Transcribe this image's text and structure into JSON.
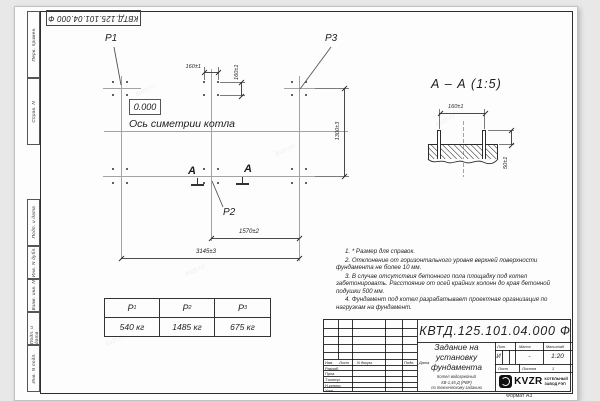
{
  "drawing": {
    "designation": "КВТД.125.101.04.000 Ф",
    "corner_designation": "КВТД.125.101.04.000 Ф",
    "format": "Формат А3",
    "watermark": "kvzr.ru"
  },
  "margin_column": {
    "labels": [
      "Перв. примен.",
      "Справ. N",
      "Подп. и дата",
      "Инв. N дубл.",
      "Взам. инв. N",
      "Подп. и дата",
      "Инв. N подл."
    ]
  },
  "plan": {
    "point1": "P1",
    "point2": "P2",
    "point3": "P3",
    "elevation": "0.000",
    "symmetry_label": "Ось симетрии котла",
    "section_mark_left": "А",
    "section_mark_right": "А",
    "dim_160_horizontal": "160±1",
    "dim_160_vertical": "160±1",
    "dim_1300": "1300±3",
    "dim_1570": "1570±2",
    "dim_3145": "3145±3"
  },
  "section_view": {
    "title": "А – А (1:5)",
    "dim_160": "160±1",
    "dim_50": "50±1"
  },
  "load_table": {
    "columns": [
      {
        "base": "P",
        "sub": "1",
        "value": "540 кг"
      },
      {
        "base": "P",
        "sub": "2",
        "value": "1485 кг"
      },
      {
        "base": "P",
        "sub": "3",
        "value": "675 кг"
      }
    ]
  },
  "notes": {
    "items": [
      "1. * Размер для справок.",
      "2. Отклонение от горизонтального уровня верхней поверхности фундамента не более 10 мм.",
      "3. В случае отсутствия бетонного пола площадку под котел забетонировать. Расстояние от осей крайних колонн до края бетонной подушки 500 мм.",
      "4. Фундамент под котел разрабатывает проектная организация по нагрузкам на фундамент."
    ]
  },
  "title_block": {
    "designation": "КВТД.125.101.04.000 Ф",
    "title": "Задание на установку фундамента",
    "product_line1": "Котел водогрейный",
    "product_line2": "КВ-1,45 Д (РВР)",
    "product_line3": "по техническому заданию",
    "col_izm": "Изм.",
    "col_list": "Лист",
    "col_doc": "N докум.",
    "col_podp": "Подп.",
    "col_data": "Дата",
    "row_razrab": "Разраб.",
    "row_prov": "Пров.",
    "row_tkontr": "Т.контр.",
    "row_nkontr": "Н.контр.",
    "row_utv": "Утв.",
    "lit_header": "Лит.",
    "mass_header": "Масса",
    "scale_header": "Масштаб",
    "lit_value": "И",
    "mass_value": "-",
    "scale_value": "1:20",
    "sheet_label": "Лист",
    "sheets_label": "Листов",
    "sheets_value": "1",
    "logo_text": "KVZR",
    "org_line1": "КОТЕЛЬНЫЙ",
    "org_line2": "ЗАВОД РЭП"
  }
}
